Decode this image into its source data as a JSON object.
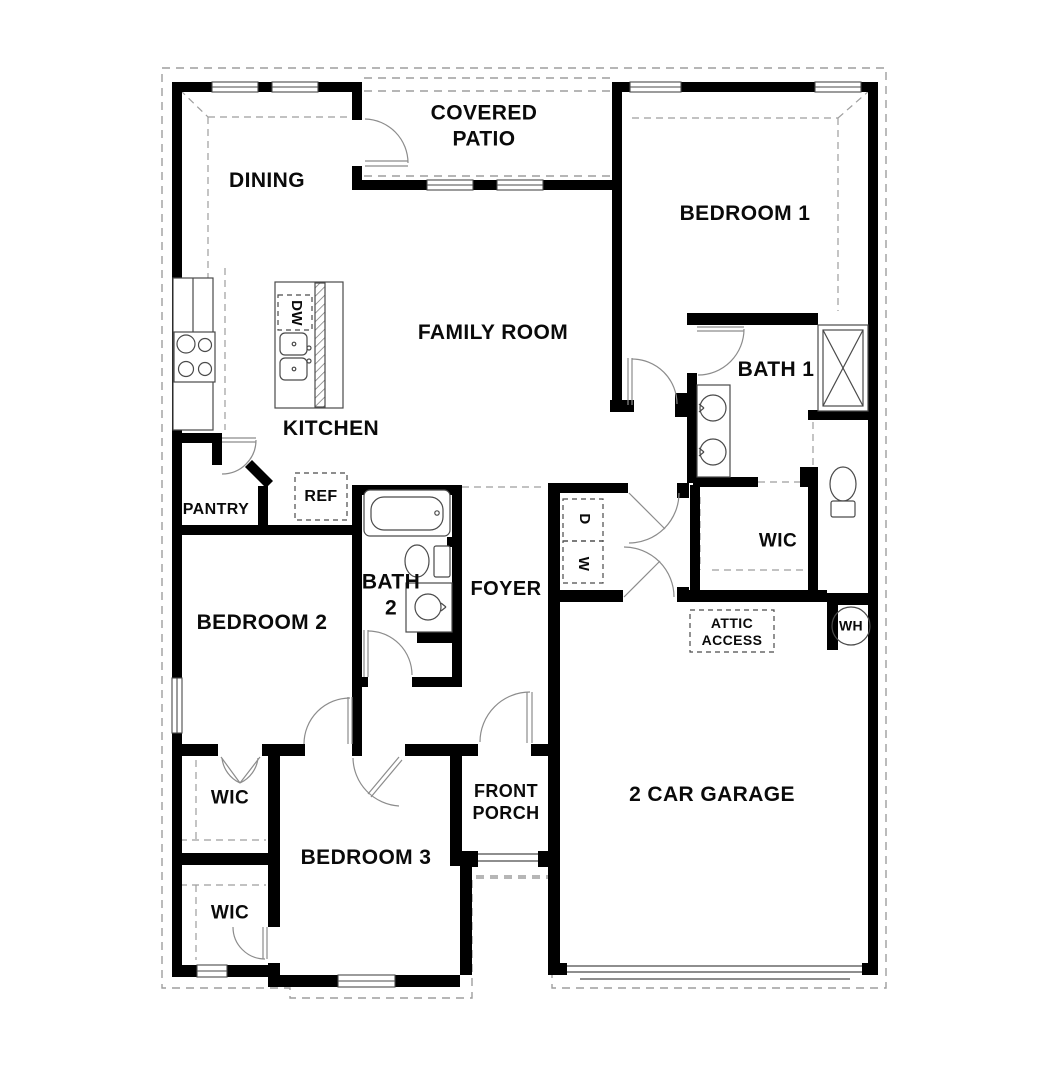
{
  "plan": {
    "title": "single-story house floor plan",
    "labels": {
      "dining": "DINING",
      "covered_patio": "COVERED\nPATIO",
      "bedroom1": "BEDROOM 1",
      "family_room": "FAMILY ROOM",
      "bath1": "BATH 1",
      "kitchen": "KITCHEN",
      "pantry": "PANTRY",
      "ref": "REF",
      "dw": "DW",
      "bath2": "BATH\n2",
      "foyer": "FOYER",
      "dryer": "D",
      "washer": "W",
      "wic_master": "WIC",
      "attic_access": "ATTIC\nACCESS",
      "water_heater": "WH",
      "bedroom2": "BEDROOM 2",
      "wic_hall": "WIC",
      "wic_bedroom3": "WIC",
      "bedroom3": "BEDROOM 3",
      "front_porch": "FRONT\nPORCH",
      "garage": "2 CAR GARAGE"
    },
    "colors": {
      "wall": "#000000",
      "fixture_line": "#4a4a4a",
      "door_line": "#8c8c8c",
      "dash_line": "#9e9e9e",
      "background": "#ffffff",
      "text": "#0a0a0a"
    }
  }
}
